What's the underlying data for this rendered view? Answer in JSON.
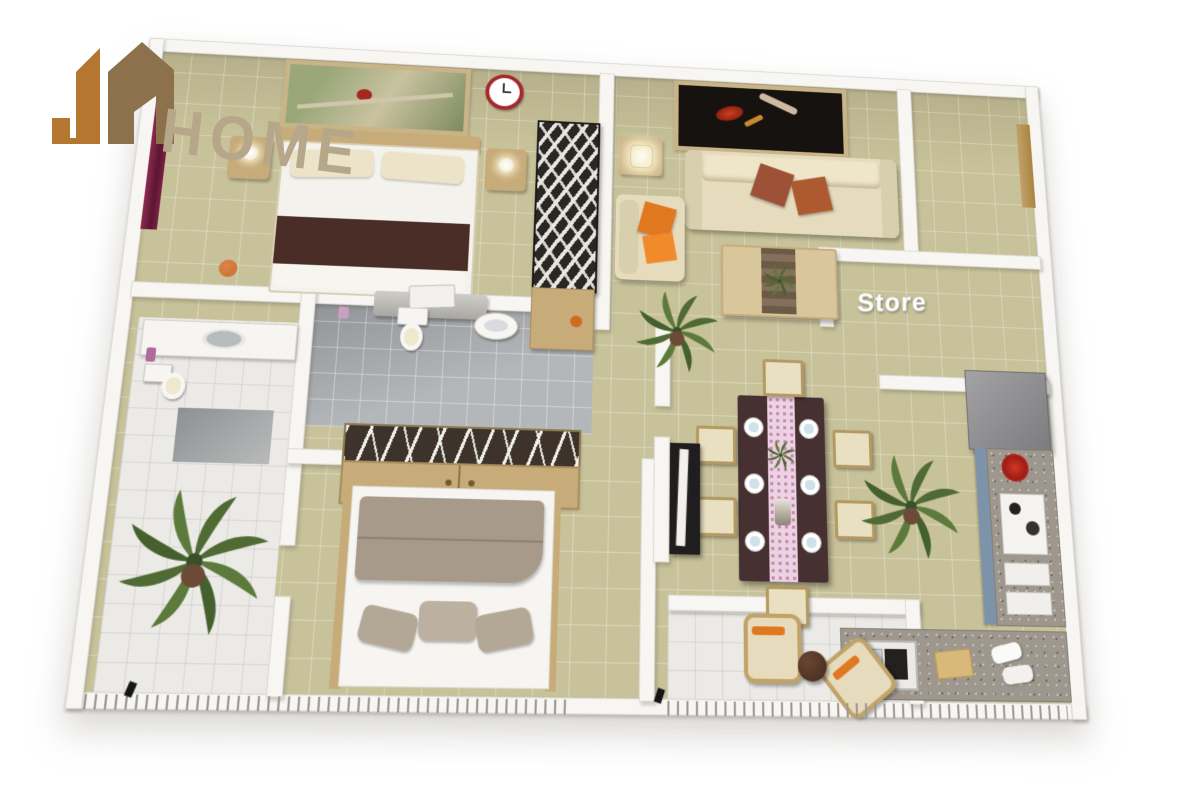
{
  "logo": {
    "jm_monogram": "JM",
    "home_text": "HOME"
  },
  "labels": {
    "store_room": "Store"
  },
  "colors": {
    "page": "#ffffff",
    "wall": "#f7f6f3",
    "floor": "#c8c29a",
    "bathfloor": "#b4b7ba",
    "whitefloor": "#ebeae6",
    "logo-orange": "#b5772f",
    "logo-brown": "#8d714c",
    "logo-tan": "#b7a78a",
    "frame": "#c9b488",
    "wood": "#c7ab79",
    "wood-light": "#d9c69a",
    "blanket-maroon": "#4a2d27",
    "pillow-cream": "#ece3c8",
    "sofa-cream": "#e6dcbd",
    "rust": "#9d5136",
    "orange-pillow": "#e07820",
    "dining-table": "#463031",
    "runner-pink": "#ecd3e3",
    "granite": "#9d978d",
    "cabinet-blue": "#7d93aa",
    "fridge-gray": "#8f8f91",
    "plant-green": "#4f6b33",
    "tv-black": "#1f1d1e",
    "clock-red": "#a5282c",
    "taupe": "#a79a8b",
    "basketball": "#c96a32",
    "curtain-maroon": "#6d1e3c"
  },
  "icons": [
    "jm-building-logo-icon",
    "wall-clock-icon",
    "ladybug-artwork",
    "dancers-artwork",
    "palm-plant",
    "basketball",
    "door-swing-marker",
    "table-lamp-icon"
  ],
  "scene": {
    "type": "3d-isometric-floorplan-render",
    "rooms": [
      {
        "name": "master-bedroom",
        "furniture": [
          "double-bed",
          "nightstand-left",
          "nightstand-right",
          "wall-art-ladybug",
          "wall-clock",
          "basketball",
          "tv-dresser",
          "curtain"
        ]
      },
      {
        "name": "living-room",
        "furniture": [
          "sofa",
          "rust-cushions",
          "armchair",
          "lamp-table",
          "coffee-table",
          "zebra-shelf",
          "wall-art-dancers",
          "palm-plant"
        ]
      },
      {
        "name": "entry-hall",
        "furniture": [
          "entry-door"
        ]
      },
      {
        "name": "store-room",
        "furniture": [
          "refrigerator"
        ],
        "label": "Store"
      },
      {
        "name": "kitchen",
        "furniture": [
          "l-counter",
          "blue-cabinets",
          "sink",
          "stove",
          "red-bowl",
          "cutting-board",
          "towels"
        ]
      },
      {
        "name": "dining-room",
        "furniture": [
          "dining-table",
          "six-chairs",
          "place-settings",
          "table-runner",
          "centerpiece-plant",
          "tv-cabinet"
        ]
      },
      {
        "name": "bathroom-main",
        "furniture": [
          "toilet",
          "wall-sink"
        ]
      },
      {
        "name": "wardrobe-nook",
        "furniture": [
          "open-wardrobe-with-hangers"
        ]
      },
      {
        "name": "bathroom-second",
        "furniture": [
          "toilet",
          "counter-sink"
        ]
      },
      {
        "name": "bedroom-second",
        "furniture": [
          "bed",
          "pillows"
        ]
      },
      {
        "name": "left-balcony",
        "furniture": [
          "palm-plant"
        ]
      },
      {
        "name": "terrace",
        "furniture": [
          "armchair",
          "armchair",
          "round-side-table"
        ]
      }
    ]
  }
}
